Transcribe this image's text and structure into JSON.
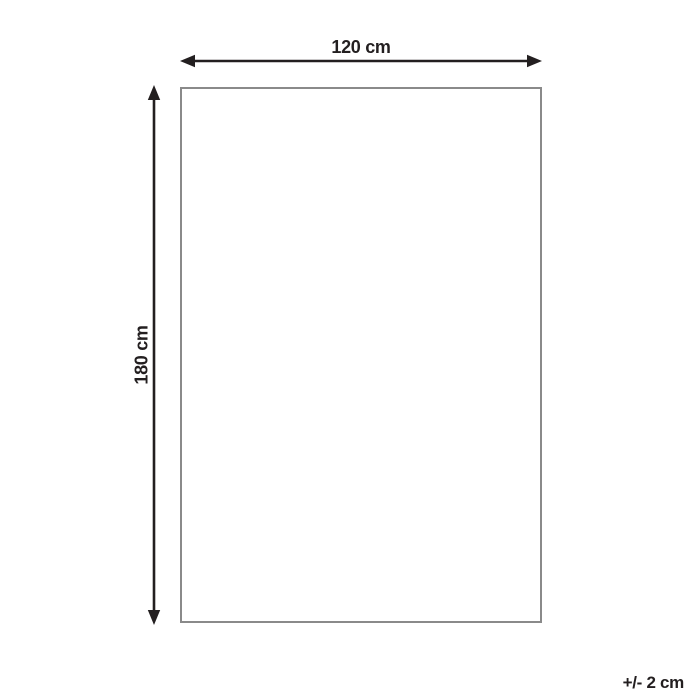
{
  "diagram": {
    "width_label": "120 cm",
    "height_label": "180 cm",
    "tolerance_label": "+/- 2 cm",
    "colors": {
      "arrow": "#231f20",
      "outline": "#8a8a8a",
      "background": "#ffffff",
      "text": "#231f20"
    }
  }
}
